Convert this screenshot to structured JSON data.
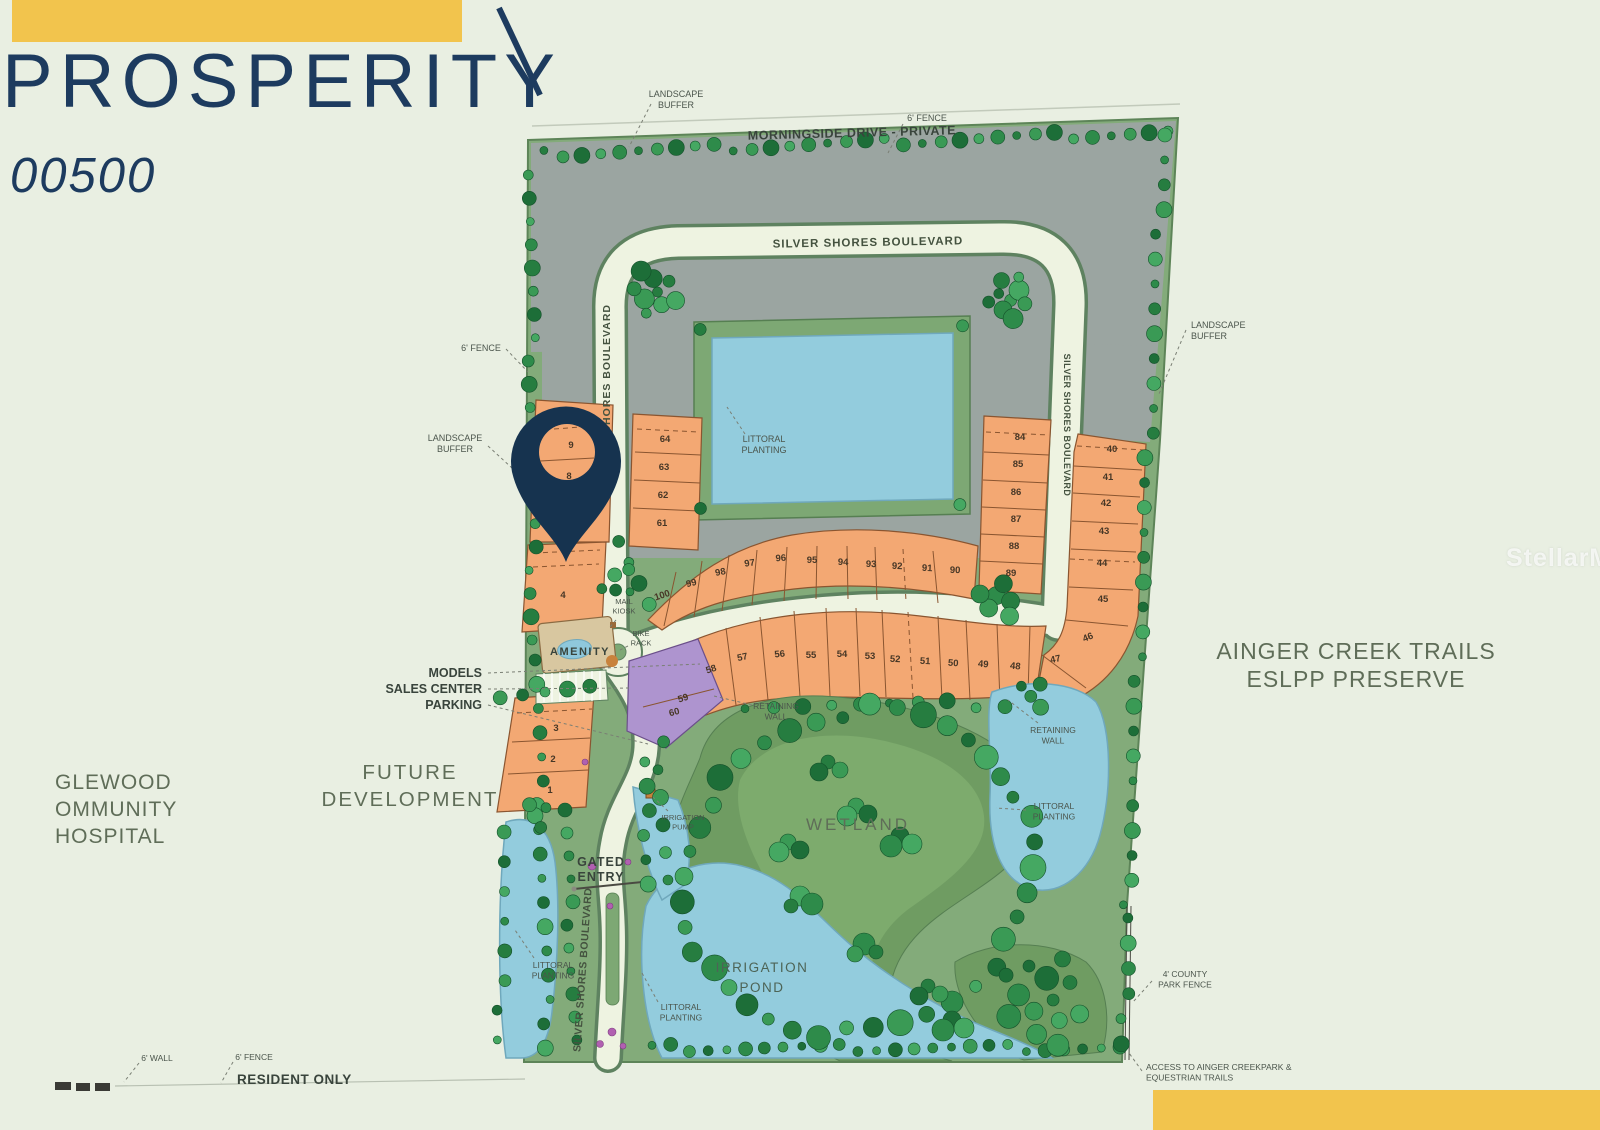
{
  "header": {
    "title": "PROSPERITY",
    "lot_id": "00500"
  },
  "watermark": "StellarMLS",
  "colors": {
    "accent": "#f2c44d",
    "navy": "#1d3b5f",
    "pin": "#16334f",
    "lot_orange": "#f3a873",
    "lot_purple": "#ae94cf",
    "water": "#93ccdd",
    "grass": "#83ab7a",
    "wetland": "#6f9c62",
    "gray_future": "#9ba5a1",
    "road": "#eef3e1",
    "ink_ann": "#4b554c",
    "ink_dark": "#39443c",
    "ink_area": "#5f6d58",
    "ink_road": "#44523f",
    "ink_pond": "#4d6456",
    "tree_greens": [
      "#267d40",
      "#3a9a55",
      "#1d6e38",
      "#45a862",
      "#2e8b4a"
    ],
    "flower": "#b160b1"
  },
  "map": {
    "lots": [
      {
        "n": "9",
        "x": 571,
        "y": 448
      },
      {
        "n": "8",
        "x": 569,
        "y": 479
      },
      {
        "n": "4",
        "x": 563,
        "y": 598
      },
      {
        "n": "3",
        "x": 556,
        "y": 731
      },
      {
        "n": "2",
        "x": 553,
        "y": 762
      },
      {
        "n": "1",
        "x": 550,
        "y": 793
      },
      {
        "n": "64",
        "x": 665,
        "y": 442
      },
      {
        "n": "63",
        "x": 664,
        "y": 470
      },
      {
        "n": "62",
        "x": 663,
        "y": 498
      },
      {
        "n": "61",
        "x": 662,
        "y": 526
      },
      {
        "n": "100",
        "x": 663,
        "y": 598,
        "rot": -18
      },
      {
        "n": "99",
        "x": 692,
        "y": 586,
        "rot": -14
      },
      {
        "n": "98",
        "x": 721,
        "y": 575,
        "rot": -11
      },
      {
        "n": "97",
        "x": 750,
        "y": 566,
        "rot": -8
      },
      {
        "n": "96",
        "x": 781,
        "y": 561,
        "rot": -4
      },
      {
        "n": "95",
        "x": 812,
        "y": 563
      },
      {
        "n": "94",
        "x": 843,
        "y": 565,
        "rot": 2
      },
      {
        "n": "93",
        "x": 871,
        "y": 567,
        "rot": 2
      },
      {
        "n": "92",
        "x": 897,
        "y": 569,
        "rot": 3
      },
      {
        "n": "91",
        "x": 927,
        "y": 571,
        "rot": 3
      },
      {
        "n": "90",
        "x": 955,
        "y": 573,
        "rot": 2
      },
      {
        "n": "84",
        "x": 1020,
        "y": 440
      },
      {
        "n": "85",
        "x": 1018,
        "y": 467
      },
      {
        "n": "86",
        "x": 1016,
        "y": 495
      },
      {
        "n": "87",
        "x": 1016,
        "y": 522
      },
      {
        "n": "88",
        "x": 1014,
        "y": 549
      },
      {
        "n": "89",
        "x": 1011,
        "y": 576
      },
      {
        "n": "40",
        "x": 1112,
        "y": 452
      },
      {
        "n": "41",
        "x": 1108,
        "y": 480
      },
      {
        "n": "42",
        "x": 1106,
        "y": 506
      },
      {
        "n": "43",
        "x": 1104,
        "y": 534
      },
      {
        "n": "44",
        "x": 1102,
        "y": 566
      },
      {
        "n": "45",
        "x": 1103,
        "y": 602
      },
      {
        "n": "46",
        "x": 1089,
        "y": 640,
        "rot": -22
      },
      {
        "n": "58",
        "x": 712,
        "y": 672,
        "rot": -18
      },
      {
        "n": "57",
        "x": 743,
        "y": 660,
        "rot": -12
      },
      {
        "n": "56",
        "x": 780,
        "y": 657,
        "rot": -6
      },
      {
        "n": "55",
        "x": 811,
        "y": 658
      },
      {
        "n": "54",
        "x": 842,
        "y": 657
      },
      {
        "n": "53",
        "x": 870,
        "y": 659
      },
      {
        "n": "52",
        "x": 895,
        "y": 662,
        "rot": 3
      },
      {
        "n": "51",
        "x": 925,
        "y": 664,
        "rot": 3
      },
      {
        "n": "50",
        "x": 953,
        "y": 666,
        "rot": 4
      },
      {
        "n": "49",
        "x": 983,
        "y": 667,
        "rot": 5
      },
      {
        "n": "48",
        "x": 1015,
        "y": 669,
        "rot": 6
      },
      {
        "n": "47",
        "x": 1056,
        "y": 662,
        "rot": -12
      },
      {
        "n": "59",
        "x": 684,
        "y": 701,
        "rot": -18
      },
      {
        "n": "60",
        "x": 675,
        "y": 715,
        "rot": -15
      }
    ],
    "labels": [
      {
        "id": "landscape-buffer-nw",
        "lines": [
          "LANDSCAPE",
          "BUFFER"
        ],
        "x": 676,
        "y": 97,
        "size": 9,
        "color": "ann",
        "anchor": "middle",
        "leader": [
          651,
          104,
          629,
          147
        ]
      },
      {
        "id": "morningside-drive",
        "lines": [
          "MORNINGSIDE DRIVE - PRIVATE"
        ],
        "x": 852,
        "y": 137,
        "size": 12.5,
        "bold": 1,
        "rot": -1.5,
        "color": "dark",
        "anchor": "middle",
        "ls": 0.5
      },
      {
        "id": "fence-ne",
        "lines": [
          "6' FENCE"
        ],
        "x": 927,
        "y": 121,
        "size": 9,
        "color": "ann",
        "anchor": "middle",
        "leader": [
          903,
          124,
          888,
          153
        ]
      },
      {
        "id": "silver-shores-top",
        "lines": [
          "SILVER SHORES BOULEVARD"
        ],
        "x": 868,
        "y": 246,
        "size": 11.5,
        "bold": 1,
        "rot": -1,
        "color": "road",
        "anchor": "middle",
        "ls": 1
      },
      {
        "id": "silver-shores-west",
        "lines": [
          "SILVER SHORES BOULEVARD"
        ],
        "x": 610,
        "y": 392,
        "size": 10.5,
        "bold": 1,
        "rot": -90,
        "color": "road",
        "anchor": "middle",
        "ls": 1
      },
      {
        "id": "silver-shores-east",
        "lines": [
          "SILVER SHORES BOULEVARD"
        ],
        "x": 1064,
        "y": 425,
        "size": 9,
        "bold": 1,
        "rot": 90,
        "color": "road",
        "anchor": "middle",
        "ls": 0.5
      },
      {
        "id": "fence-w",
        "lines": [
          "6' FENCE"
        ],
        "x": 481,
        "y": 351,
        "size": 9,
        "color": "ann",
        "anchor": "middle",
        "leader": [
          506,
          349,
          528,
          372
        ]
      },
      {
        "id": "landscape-buffer-w",
        "lines": [
          "LANDSCAPE",
          "BUFFER"
        ],
        "x": 455,
        "y": 441,
        "size": 9,
        "color": "ann",
        "anchor": "middle",
        "leader": [
          488,
          446,
          512,
          468
        ]
      },
      {
        "id": "landscape-buffer-e",
        "lines": [
          "LANDSCAPE",
          "BUFFER"
        ],
        "x": 1191,
        "y": 328,
        "size": 9,
        "color": "ann",
        "anchor": "start",
        "leader": [
          1186,
          330,
          1159,
          394
        ]
      },
      {
        "id": "littoral-planting-n",
        "lines": [
          "LITTORAL",
          "PLANTING"
        ],
        "x": 764,
        "y": 442,
        "size": 9,
        "color": "ann",
        "anchor": "middle",
        "leader": [
          745,
          434,
          727,
          407
        ]
      },
      {
        "id": "mail-kiosk",
        "lines": [
          "MAIL",
          "KIOSK"
        ],
        "x": 624,
        "y": 604,
        "size": 7.5,
        "color": "ann",
        "anchor": "middle",
        "leader": [
          616,
          620,
          610,
          627
        ]
      },
      {
        "id": "bike-rack",
        "lines": [
          "BIKE",
          "RACK"
        ],
        "x": 641,
        "y": 636,
        "size": 7.5,
        "color": "ann",
        "anchor": "middle",
        "leader": [
          628,
          646,
          618,
          651
        ]
      },
      {
        "id": "amenity",
        "lines": [
          "AMENITY"
        ],
        "x": 580,
        "y": 655,
        "size": 11,
        "bold": 1,
        "color": "dark",
        "anchor": "middle",
        "ls": 1.5
      },
      {
        "id": "models",
        "lines": [
          "MODELS"
        ],
        "x": 482,
        "y": 677,
        "size": 12.5,
        "bold": 1,
        "color": "dark",
        "anchor": "end",
        "leader": [
          488,
          673,
          700,
          664
        ]
      },
      {
        "id": "sales-center",
        "lines": [
          "SALES CENTER"
        ],
        "x": 482,
        "y": 693,
        "size": 12.5,
        "bold": 1,
        "color": "dark",
        "anchor": "end",
        "leader": [
          488,
          689,
          632,
          688
        ]
      },
      {
        "id": "parking",
        "lines": [
          "PARKING"
        ],
        "x": 482,
        "y": 709,
        "size": 12.5,
        "bold": 1,
        "color": "dark",
        "anchor": "end",
        "leader": [
          488,
          705,
          648,
          744
        ]
      },
      {
        "id": "retaining-wall-w",
        "lines": [
          "RETAINING",
          "WALL"
        ],
        "x": 776,
        "y": 709,
        "size": 8.5,
        "color": "ann",
        "anchor": "middle",
        "leader": [
          752,
          705,
          714,
          696
        ]
      },
      {
        "id": "retaining-wall-e",
        "lines": [
          "RETAINING",
          "WALL"
        ],
        "x": 1053,
        "y": 733,
        "size": 8.5,
        "color": "ann",
        "anchor": "middle",
        "leader": [
          1038,
          723,
          1008,
          700
        ]
      },
      {
        "id": "littoral-planting-e",
        "lines": [
          "LITTORAL",
          "PLANTING"
        ],
        "x": 1054,
        "y": 809,
        "size": 8.5,
        "color": "ann",
        "anchor": "middle",
        "leader": [
          1026,
          810,
          996,
          808
        ]
      },
      {
        "id": "wetland",
        "lines": [
          "WETLAND"
        ],
        "x": 858,
        "y": 830,
        "size": 17,
        "color": "area",
        "anchor": "middle",
        "ls": 3
      },
      {
        "id": "future-development",
        "lines": [
          "FUTURE",
          "DEVELOPMENT"
        ],
        "x": 410,
        "y": 779,
        "size": 20.5,
        "color": "area",
        "anchor": "middle",
        "ls": 2,
        "lh": 27
      },
      {
        "id": "hospital",
        "lines": [
          "GLEWOOD",
          "OMMUNITY",
          "HOSPITAL"
        ],
        "x": 55,
        "y": 789,
        "size": 21,
        "color": "area",
        "anchor": "start",
        "ls": 1,
        "lh": 27
      },
      {
        "id": "preserve",
        "lines": [
          "AINGER CREEK TRAILS",
          "ESLPP PRESERVE"
        ],
        "x": 1356,
        "y": 659,
        "size": 23,
        "color": "area",
        "anchor": "middle",
        "ls": 1,
        "lh": 28
      },
      {
        "id": "irrigation-pump",
        "lines": [
          "IRRIGATION",
          "PUMP"
        ],
        "x": 683,
        "y": 820,
        "size": 7.5,
        "color": "ann",
        "anchor": "middle",
        "leader": [
          668,
          811,
          653,
          797
        ]
      },
      {
        "id": "gated-entry",
        "lines": [
          "GATED",
          "ENTRY"
        ],
        "x": 601,
        "y": 866,
        "size": 12.5,
        "bold": 1,
        "color": "dark",
        "anchor": "middle",
        "lh": 15,
        "ls": 1
      },
      {
        "id": "silver-shores-entry",
        "lines": [
          "SILVER SHORES BOULEVARD"
        ],
        "x": 586,
        "y": 970,
        "size": 10.5,
        "bold": 1,
        "rot": -86,
        "color": "road",
        "anchor": "middle",
        "ls": 0.5
      },
      {
        "id": "littoral-planting-sw",
        "lines": [
          "LITTORAL",
          "PLANTING"
        ],
        "x": 553,
        "y": 968,
        "size": 8.5,
        "color": "ann",
        "anchor": "middle",
        "leader": [
          534,
          958,
          515,
          930
        ]
      },
      {
        "id": "littoral-planting-s",
        "lines": [
          "LITTORAL",
          "PLANTING"
        ],
        "x": 681,
        "y": 1010,
        "size": 8.5,
        "color": "ann",
        "anchor": "middle",
        "leader": [
          658,
          1002,
          642,
          973
        ]
      },
      {
        "id": "irrigation-pond",
        "lines": [
          "IRRIGATION",
          "POND"
        ],
        "x": 762,
        "y": 972,
        "size": 13.5,
        "color": "pond",
        "anchor": "middle",
        "ls": 1.5,
        "lh": 20
      },
      {
        "id": "wall-sw",
        "lines": [
          "6' WALL"
        ],
        "x": 157,
        "y": 1061,
        "size": 8.5,
        "color": "ann",
        "anchor": "middle",
        "leader": [
          139,
          1063,
          124,
          1082
        ]
      },
      {
        "id": "fence-s",
        "lines": [
          "6' FENCE"
        ],
        "x": 254,
        "y": 1060,
        "size": 8.5,
        "color": "ann",
        "anchor": "middle",
        "leader": [
          233,
          1062,
          221,
          1083
        ]
      },
      {
        "id": "resident-only",
        "lines": [
          "RESIDENT ONLY"
        ],
        "x": 237,
        "y": 1084,
        "size": 13.5,
        "bold": 1,
        "color": "dark",
        "anchor": "start",
        "ls": 0.5
      },
      {
        "id": "county-park-fence",
        "lines": [
          "4' COUNTY",
          "PARK FENCE"
        ],
        "x": 1185,
        "y": 977,
        "size": 8.5,
        "color": "ann",
        "anchor": "middle",
        "leader": [
          1152,
          981,
          1133,
          1002
        ]
      },
      {
        "id": "access-trails",
        "lines": [
          "ACCESS TO AINGER CREEKPARK &",
          "EQUESTRIAN TRAILS"
        ],
        "x": 1146,
        "y": 1070,
        "size": 8.5,
        "color": "ann",
        "anchor": "start",
        "leader": [
          1142,
          1071,
          1129,
          1053
        ]
      }
    ]
  }
}
